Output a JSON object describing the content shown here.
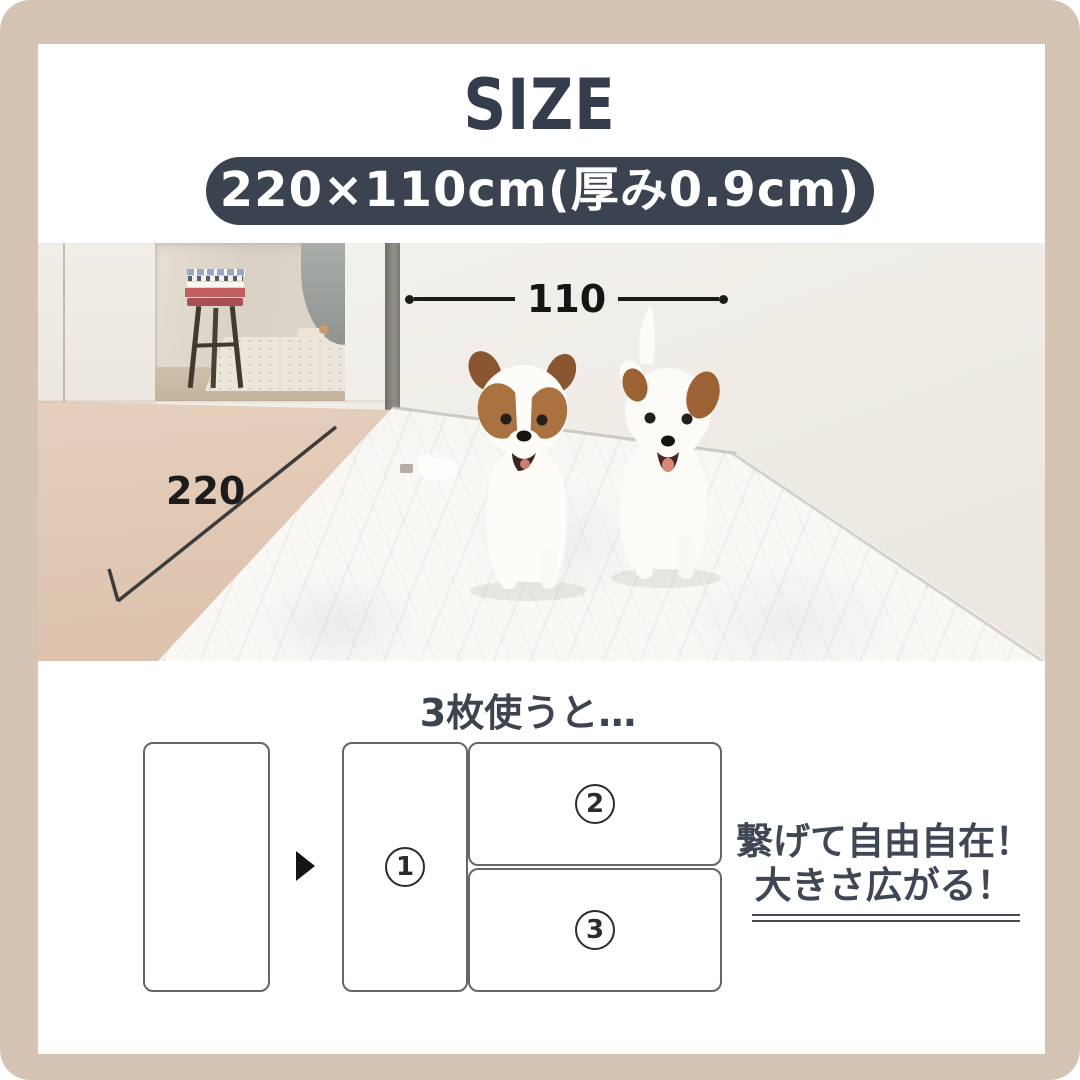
{
  "header": {
    "title": "SIZE",
    "size_pill_label": "220×110cm(厚み0.9cm)"
  },
  "photo": {
    "width_label": "110",
    "length_label": "220"
  },
  "usage_section": {
    "heading": "3枚使うと…",
    "mat_numbers": [
      "1",
      "2",
      "3"
    ],
    "caption_line1": "繋げて自由自在！",
    "caption_line2": "大きさ広がる！"
  },
  "colors": {
    "frame_beige": "#d5c3b4",
    "navy_pill": "#3b4250",
    "annotation_black": "#1b1b1b",
    "dog_brown": "#aa7241"
  }
}
